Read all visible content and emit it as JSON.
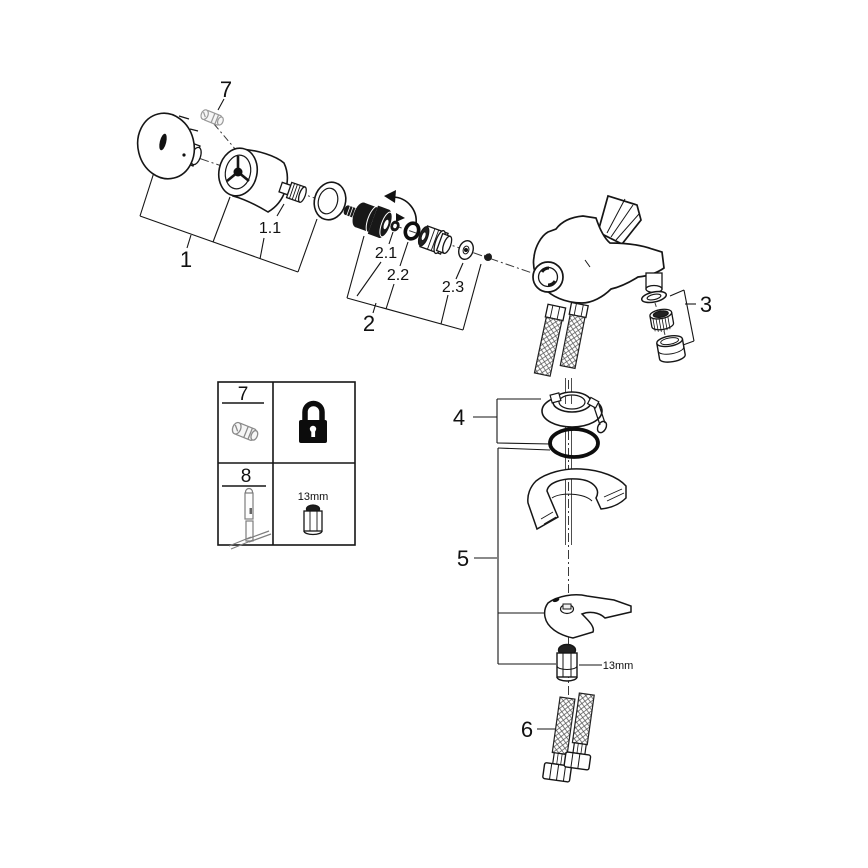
{
  "labels": {
    "p1": "1",
    "p1_1": "1.1",
    "p2": "2",
    "p2_1": "2.1",
    "p2_2": "2.2",
    "p2_3": "2.3",
    "p3": "3",
    "p4": "4",
    "p5": "5",
    "p6": "6",
    "p7": "7"
  },
  "legend": {
    "row1_number": "7",
    "row1_part_icon": "grub-screw-icon",
    "row1_icon": "padlock-icon",
    "row2_number": "8",
    "row2_part_icon": "t-handle-wrench-icon",
    "row2_socket_icon": "socket-wrench-icon",
    "row2_tool_size": "13mm"
  },
  "annotations": {
    "nut_size": "13mm"
  },
  "colors": {
    "line": "#1a1a1a",
    "dark_fill": "#141414",
    "gray_part": "#9a9a9a",
    "background": "#ffffff"
  }
}
